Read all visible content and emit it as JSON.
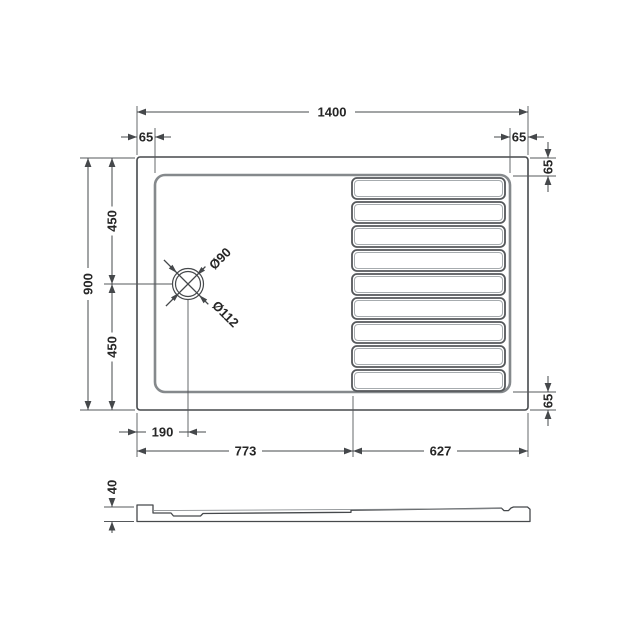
{
  "drawing": {
    "title": "shower-tray-technical-drawing",
    "views": {
      "plan": "top view of rectangular walk-in shower tray with drain and 9 anti-slip slats",
      "profile": "side elevation of tray"
    },
    "slat_count": 9
  },
  "dims": {
    "overall_width": "1400",
    "overall_depth": "900",
    "rim_top_left": "65",
    "rim_top_right": "65",
    "rim_right_top": "65",
    "rim_right_bottom": "65",
    "depth_upper": "450",
    "depth_lower": "450",
    "drain_offset": "190",
    "left_section": "773",
    "right_section": "627",
    "waste_diameter": "Ø90",
    "flange_diameter": "Ø112",
    "profile_height": "40"
  }
}
